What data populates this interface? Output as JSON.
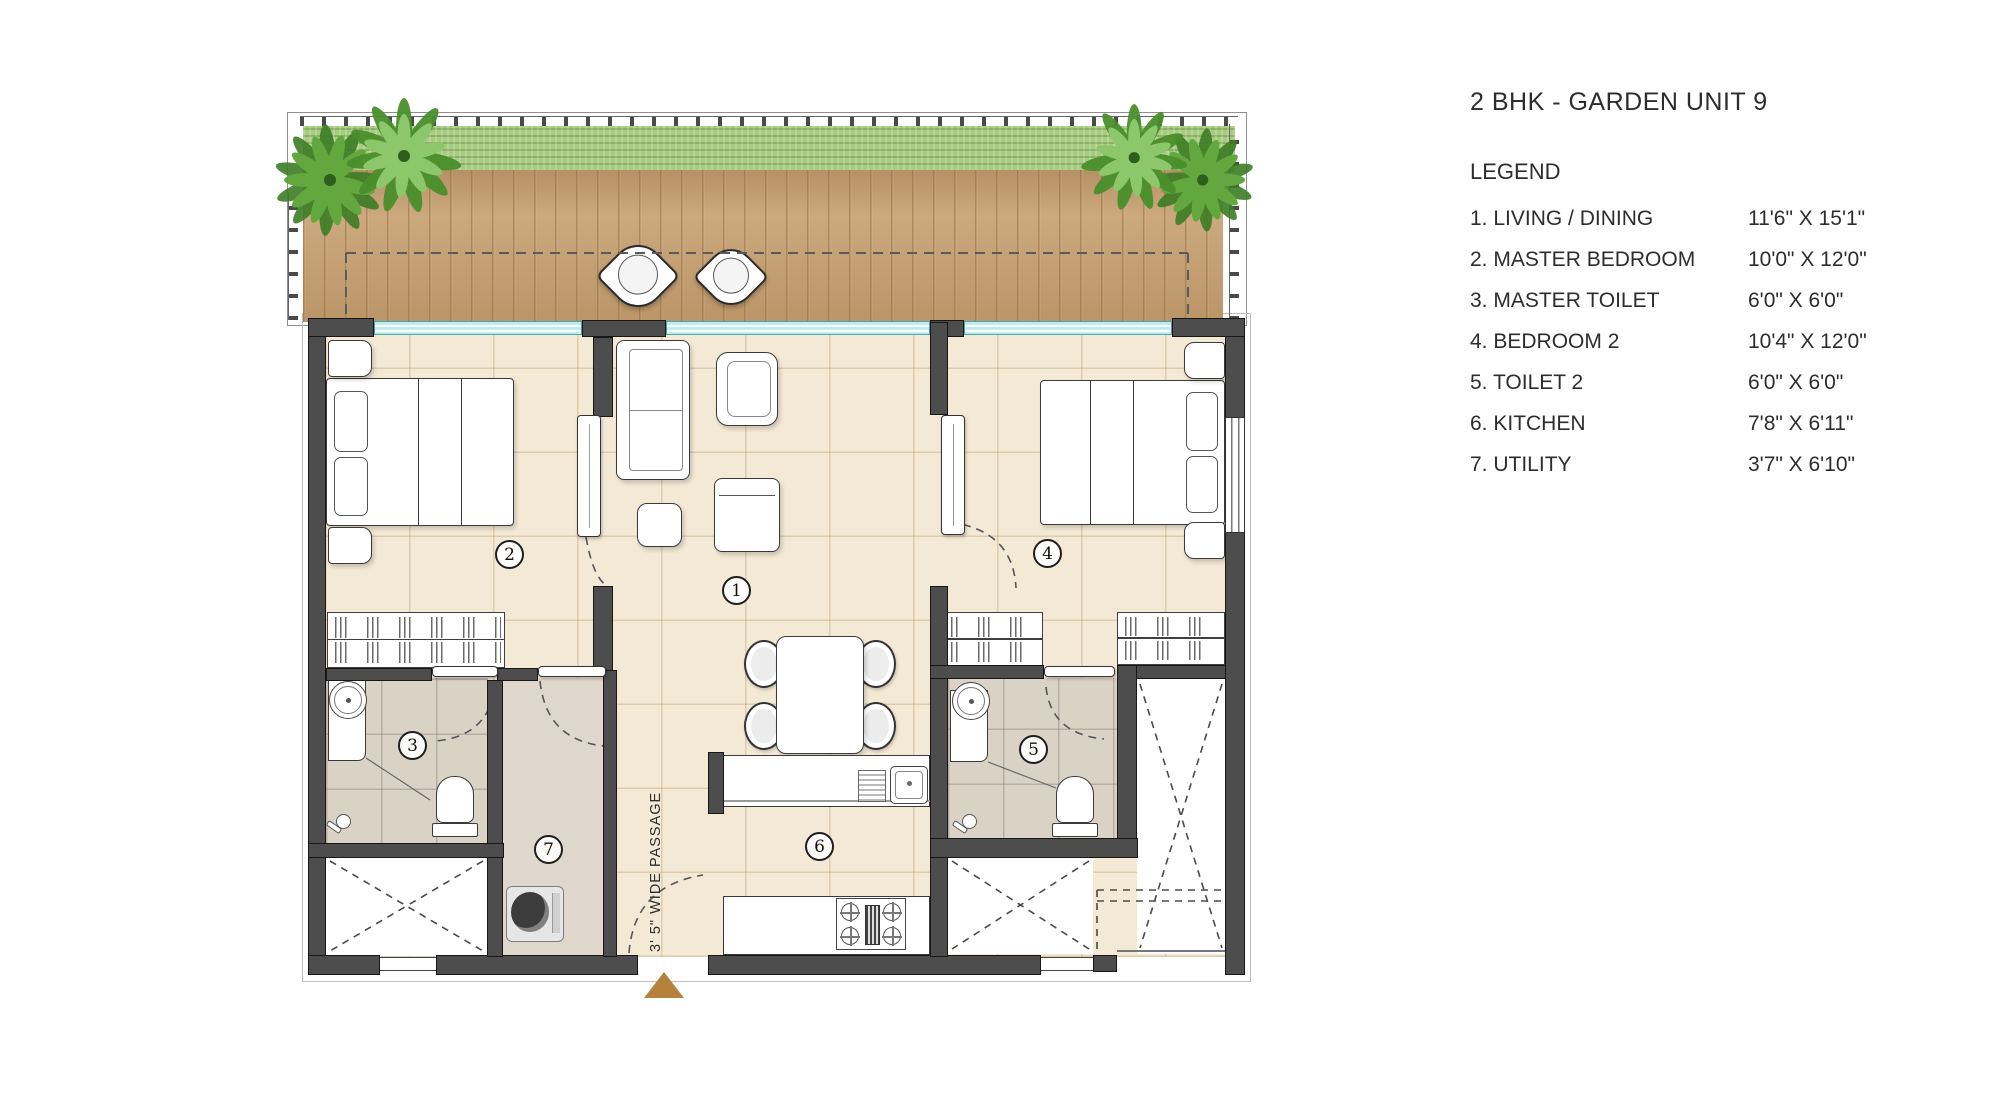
{
  "title": "2 BHK - GARDEN UNIT 9",
  "legend": {
    "heading": "LEGEND",
    "items": [
      {
        "label": "1. LIVING / DINING",
        "dim": "11'6\" X 15'1\""
      },
      {
        "label": "2. MASTER BEDROOM",
        "dim": "10'0\" X 12'0\""
      },
      {
        "label": "3. MASTER TOILET",
        "dim": "6'0\" X 6'0\""
      },
      {
        "label": "4. BEDROOM 2",
        "dim": "10'4\" X 12'0\""
      },
      {
        "label": "5. TOILET 2",
        "dim": "6'0\" X 6'0\""
      },
      {
        "label": "6. KITCHEN",
        "dim": "7'8\" X 6'11\""
      },
      {
        "label": "7. UTILITY",
        "dim": "3'7\" X 6'10\""
      }
    ]
  },
  "plan": {
    "passage_label": "3' 5\" WIDE PASSAGE",
    "room_numbers": {
      "living": "1",
      "master_bedroom": "2",
      "master_toilet": "3",
      "bedroom2": "4",
      "toilet2": "5",
      "kitchen": "6",
      "utility": "7"
    },
    "colors": {
      "wall": "#4d4d4d",
      "window_glass": "#bdedf0",
      "deck_wood": "#c7a173",
      "grass": "#a7cc80",
      "floor": "#f4e9d5",
      "bath_floor": "#dbd2c6",
      "entrance_marker": "#b5823c",
      "plant_green": "#4a8f2c"
    }
  }
}
